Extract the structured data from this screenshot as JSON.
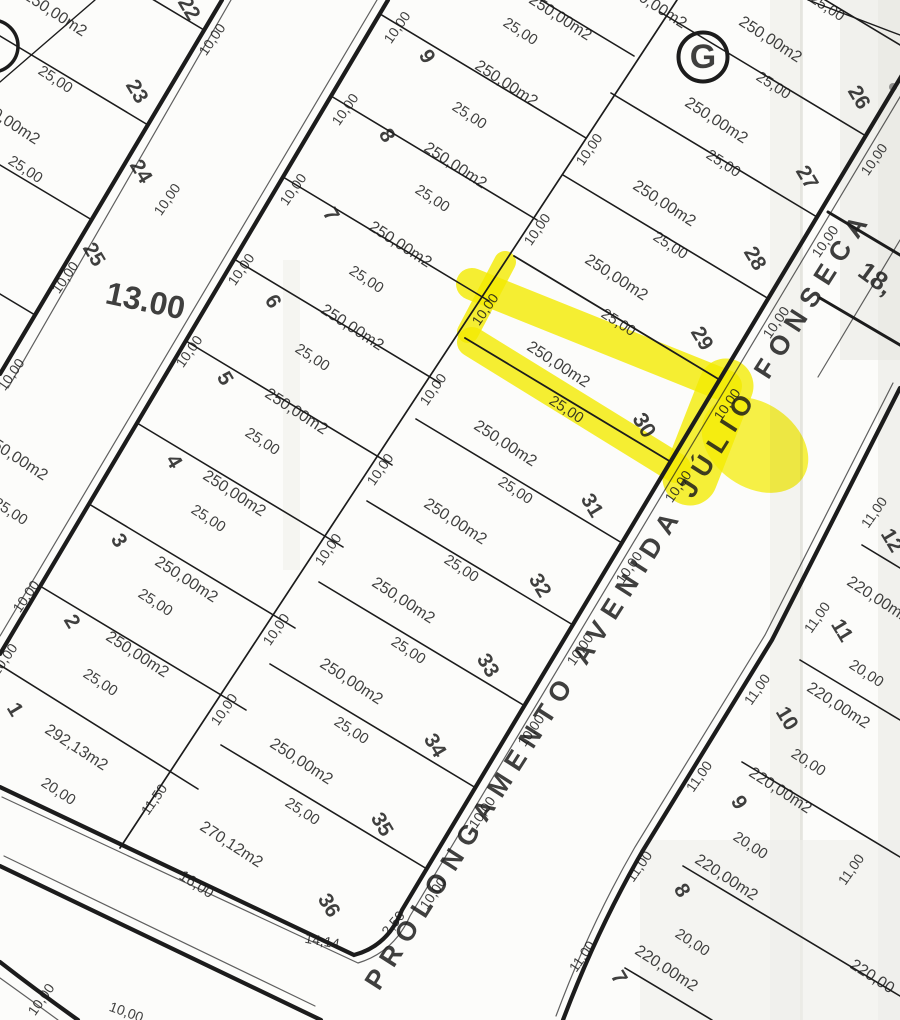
{
  "map": {
    "type": "cadastral-plat-scan",
    "street": {
      "avenue_name": "PROLONGAMENTO AVENIDA JÚLIO FONSECA",
      "left_street_width": "13.00",
      "right_street_width": "18,"
    },
    "block_marker": "G",
    "highlighted_lot": {
      "number": "30",
      "area": "250,00m2",
      "depth": "25,00",
      "front": "10,00",
      "highlight_color": "#f6ee00"
    },
    "left_block_lots": [
      "22",
      "23",
      "24",
      "25"
    ],
    "middle_block_left_column_lots": [
      "1",
      "2",
      "3",
      "4",
      "5",
      "6",
      "7",
      "8",
      "9"
    ],
    "middle_block_right_column_lots": [
      "26",
      "27",
      "28",
      "29",
      "30",
      "31",
      "32",
      "33",
      "34",
      "35",
      "36"
    ],
    "right_block_lots": [
      "7",
      "8",
      "9",
      "10",
      "11",
      "12"
    ],
    "standard_lot": {
      "area": "250,00m2",
      "depth": "25,00",
      "front": "10,00"
    },
    "right_block_lot": {
      "area": "220,00m2",
      "depth": "20,00",
      "front": "11,00"
    },
    "special_lots": {
      "lot_1": {
        "area": "292,13m2",
        "front": "20,00"
      },
      "lot_36": {
        "area": "270,12m2",
        "front": "16,00",
        "corner_chamfer": "14,14",
        "corner_offset": "2,50",
        "side": "11,50"
      }
    }
  },
  "labels": [
    {
      "t": "250,00m2",
      "x": 55,
      "y": 14,
      "r": 33,
      "s": 16
    },
    {
      "t": "25,00",
      "x": 55,
      "y": 80,
      "r": 33,
      "s": 15
    },
    {
      "t": "22",
      "x": 188,
      "y": 9,
      "r": 59,
      "s": 21,
      "w": 600
    },
    {
      "t": "23",
      "x": 136,
      "y": 92,
      "r": 59,
      "s": 21,
      "w": 600
    },
    {
      "t": "10,00",
      "x": 213,
      "y": 40,
      "r": -55,
      "s": 14
    },
    {
      "t": "250,00m2",
      "x": 8,
      "y": 122,
      "r": 33,
      "s": 16
    },
    {
      "t": "25,00",
      "x": 25,
      "y": 170,
      "r": 33,
      "s": 15
    },
    {
      "t": "24",
      "x": 140,
      "y": 172,
      "r": 59,
      "s": 21,
      "w": 600
    },
    {
      "t": "10,00",
      "x": 168,
      "y": 200,
      "r": -55,
      "s": 14
    },
    {
      "t": "25",
      "x": 93,
      "y": 255,
      "r": 59,
      "s": 21,
      "w": 600
    },
    {
      "t": "10,00",
      "x": 66,
      "y": 278,
      "r": -55,
      "s": 14
    },
    {
      "t": "10,00",
      "x": 12,
      "y": 375,
      "r": -55,
      "s": 14
    },
    {
      "t": "13.00",
      "x": 145,
      "y": 303,
      "r": 12,
      "s": 32,
      "w": 600,
      "n": "street-width-label"
    },
    {
      "t": "250,00m2",
      "x": 560,
      "y": 18,
      "r": 33,
      "s": 16
    },
    {
      "t": "25,00",
      "x": 520,
      "y": 32,
      "r": 33,
      "s": 15
    },
    {
      "t": "9",
      "x": 426,
      "y": 57,
      "r": 59,
      "s": 21,
      "w": 600
    },
    {
      "t": "250,00m2",
      "x": 506,
      "y": 84,
      "r": 33,
      "s": 16
    },
    {
      "t": "25,00",
      "x": 469,
      "y": 116,
      "r": 33,
      "s": 15
    },
    {
      "t": "8",
      "x": 386,
      "y": 136,
      "r": 59,
      "s": 21,
      "w": 600
    },
    {
      "t": "250,00m2",
      "x": 455,
      "y": 166,
      "r": 33,
      "s": 16
    },
    {
      "t": "25,00",
      "x": 432,
      "y": 199,
      "r": 33,
      "s": 15
    },
    {
      "t": "7",
      "x": 330,
      "y": 215,
      "r": 59,
      "s": 21,
      "w": 600
    },
    {
      "t": "250,00m2",
      "x": 400,
      "y": 245,
      "r": 33,
      "s": 16
    },
    {
      "t": "25,00",
      "x": 366,
      "y": 280,
      "r": 33,
      "s": 15
    },
    {
      "t": "6",
      "x": 272,
      "y": 302,
      "r": 59,
      "s": 21,
      "w": 600
    },
    {
      "t": "250,00m2",
      "x": 352,
      "y": 328,
      "r": 33,
      "s": 16
    },
    {
      "t": "25,00",
      "x": 312,
      "y": 358,
      "r": 33,
      "s": 15
    },
    {
      "t": "5",
      "x": 224,
      "y": 379,
      "r": 59,
      "s": 21,
      "w": 600
    },
    {
      "t": "250,00m2",
      "x": 296,
      "y": 412,
      "r": 33,
      "s": 16,
      "o": 0.55
    },
    {
      "t": "25,00",
      "x": 262,
      "y": 442,
      "r": 33,
      "s": 15
    },
    {
      "t": "4",
      "x": 173,
      "y": 462,
      "r": 59,
      "s": 21,
      "w": 600
    },
    {
      "t": "250,00m2",
      "x": 234,
      "y": 494,
      "r": 33,
      "s": 16
    },
    {
      "t": "25,00",
      "x": 208,
      "y": 519,
      "r": 33,
      "s": 15
    },
    {
      "t": "3",
      "x": 118,
      "y": 541,
      "r": 59,
      "s": 21,
      "w": 600
    },
    {
      "t": "250,00m2",
      "x": 186,
      "y": 580,
      "r": 33,
      "s": 16
    },
    {
      "t": "25,00",
      "x": 155,
      "y": 603,
      "r": 33,
      "s": 15
    },
    {
      "t": "2",
      "x": 71,
      "y": 622,
      "r": 59,
      "s": 21,
      "w": 600
    },
    {
      "t": "250,00m2",
      "x": 137,
      "y": 655,
      "r": 33,
      "s": 16
    },
    {
      "t": "25,00",
      "x": 100,
      "y": 683,
      "r": 33,
      "s": 15
    },
    {
      "t": "1",
      "x": 14,
      "y": 710,
      "r": 59,
      "s": 21,
      "w": 600
    },
    {
      "t": "292,13m2",
      "x": 76,
      "y": 748,
      "r": 33,
      "s": 16
    },
    {
      "t": "20,00",
      "x": 58,
      "y": 792,
      "r": 33,
      "s": 15
    },
    {
      "t": "10,00",
      "x": 398,
      "y": 28,
      "r": -55,
      "s": 14
    },
    {
      "t": "10,00",
      "x": 346,
      "y": 110,
      "r": -55,
      "s": 14
    },
    {
      "t": "10,00",
      "x": 294,
      "y": 190,
      "r": -55,
      "s": 14
    },
    {
      "t": "10,00",
      "x": 242,
      "y": 270,
      "r": -55,
      "s": 14
    },
    {
      "t": "10,00",
      "x": 190,
      "y": 352,
      "r": -55,
      "s": 14
    },
    {
      "t": "10,00",
      "x": 27,
      "y": 597,
      "r": -55,
      "s": 14
    },
    {
      "t": "10,00",
      "x": 5,
      "y": 660,
      "r": -55,
      "s": 14
    },
    {
      "t": "250,00m2",
      "x": 655,
      "y": 6,
      "r": 33,
      "s": 16
    },
    {
      "t": "25,00",
      "x": 827,
      "y": 8,
      "r": 33,
      "s": 15
    },
    {
      "t": "G",
      "x": 703,
      "y": 59,
      "r": 0,
      "s": 34,
      "w": 700,
      "n": "block-marker-g"
    },
    {
      "t": "250,00m2",
      "x": 770,
      "y": 40,
      "r": 33,
      "s": 16
    },
    {
      "t": "25,00",
      "x": 773,
      "y": 86,
      "r": 33,
      "s": 15
    },
    {
      "t": "26",
      "x": 858,
      "y": 98,
      "r": 59,
      "s": 21,
      "w": 600
    },
    {
      "t": "250,00m2",
      "x": 716,
      "y": 121,
      "r": 33,
      "s": 16
    },
    {
      "t": "25,00",
      "x": 723,
      "y": 164,
      "r": 33,
      "s": 15
    },
    {
      "t": "27",
      "x": 806,
      "y": 178,
      "r": 59,
      "s": 21,
      "w": 600
    },
    {
      "t": "250,00m2",
      "x": 664,
      "y": 204,
      "r": 33,
      "s": 16
    },
    {
      "t": "25,00",
      "x": 670,
      "y": 246,
      "r": 33,
      "s": 15
    },
    {
      "t": "28",
      "x": 754,
      "y": 259,
      "r": 59,
      "s": 21,
      "w": 600
    },
    {
      "t": "250,00m2",
      "x": 616,
      "y": 278,
      "r": 33,
      "s": 16
    },
    {
      "t": "25,00",
      "x": 618,
      "y": 323,
      "r": 33,
      "s": 15
    },
    {
      "t": "29",
      "x": 701,
      "y": 339,
      "r": 59,
      "s": 21,
      "w": 600
    },
    {
      "t": "250,00m2",
      "x": 558,
      "y": 365,
      "r": 33,
      "s": 16,
      "n": "lot-30-area"
    },
    {
      "t": "25,00",
      "x": 566,
      "y": 410,
      "r": 33,
      "s": 15,
      "n": "lot-30-depth"
    },
    {
      "t": "30",
      "x": 643,
      "y": 426,
      "r": 59,
      "s": 22,
      "w": 600,
      "n": "lot-30-number"
    },
    {
      "t": "250,00m2",
      "x": 505,
      "y": 444,
      "r": 33,
      "s": 16
    },
    {
      "t": "25,00",
      "x": 515,
      "y": 491,
      "r": 33,
      "s": 15
    },
    {
      "t": "31",
      "x": 591,
      "y": 506,
      "r": 59,
      "s": 21,
      "w": 600
    },
    {
      "t": "250,00m2",
      "x": 455,
      "y": 522,
      "r": 33,
      "s": 16
    },
    {
      "t": "25,00",
      "x": 461,
      "y": 569,
      "r": 33,
      "s": 15
    },
    {
      "t": "32",
      "x": 539,
      "y": 586,
      "r": 59,
      "s": 21,
      "w": 600
    },
    {
      "t": "250,00m2",
      "x": 403,
      "y": 601,
      "r": 33,
      "s": 16
    },
    {
      "t": "25,00",
      "x": 408,
      "y": 651,
      "r": 33,
      "s": 15
    },
    {
      "t": "33",
      "x": 487,
      "y": 666,
      "r": 59,
      "s": 21,
      "w": 600
    },
    {
      "t": "250,00m2",
      "x": 351,
      "y": 682,
      "r": 33,
      "s": 16
    },
    {
      "t": "25,00",
      "x": 351,
      "y": 731,
      "r": 33,
      "s": 15
    },
    {
      "t": "34",
      "x": 434,
      "y": 746,
      "r": 59,
      "s": 21,
      "w": 600
    },
    {
      "t": "250,00m2",
      "x": 301,
      "y": 762,
      "r": 33,
      "s": 16
    },
    {
      "t": "25,00",
      "x": 302,
      "y": 812,
      "r": 33,
      "s": 15
    },
    {
      "t": "35",
      "x": 381,
      "y": 825,
      "r": 59,
      "s": 21,
      "w": 600
    },
    {
      "t": "270,12m2",
      "x": 231,
      "y": 845,
      "r": 33,
      "s": 16
    },
    {
      "t": "16,00",
      "x": 196,
      "y": 885,
      "r": 33,
      "s": 15
    },
    {
      "t": "36",
      "x": 328,
      "y": 906,
      "r": 59,
      "s": 21,
      "w": 600
    },
    {
      "t": "14,14",
      "x": 322,
      "y": 942,
      "r": 10,
      "s": 14
    },
    {
      "t": "2,50",
      "x": 394,
      "y": 924,
      "r": -50,
      "s": 14
    },
    {
      "t": "11,50",
      "x": 155,
      "y": 800,
      "r": -55,
      "s": 14
    },
    {
      "t": "10,00",
      "x": 590,
      "y": 150,
      "r": -55,
      "s": 14
    },
    {
      "t": "10,00",
      "x": 538,
      "y": 230,
      "r": -55,
      "s": 14
    },
    {
      "t": "10,00",
      "x": 486,
      "y": 310,
      "r": -55,
      "s": 14
    },
    {
      "t": "10,00",
      "x": 434,
      "y": 390,
      "r": -55,
      "s": 14
    },
    {
      "t": "10,00",
      "x": 381,
      "y": 470,
      "r": -55,
      "s": 14
    },
    {
      "t": "10,00",
      "x": 329,
      "y": 550,
      "r": -55,
      "s": 14
    },
    {
      "t": "10,00",
      "x": 277,
      "y": 630,
      "r": -55,
      "s": 14
    },
    {
      "t": "10,00",
      "x": 225,
      "y": 710,
      "r": -55,
      "s": 14
    },
    {
      "t": "10,00",
      "x": 875,
      "y": 160,
      "r": -55,
      "s": 14
    },
    {
      "t": "10,00",
      "x": 826,
      "y": 242,
      "r": -55,
      "s": 14
    },
    {
      "t": "10,00",
      "x": 777,
      "y": 323,
      "r": -55,
      "s": 14
    },
    {
      "t": "10,00",
      "x": 728,
      "y": 405,
      "r": -55,
      "s": 14
    },
    {
      "t": "10,00",
      "x": 679,
      "y": 487,
      "r": -55,
      "s": 14
    },
    {
      "t": "10,00",
      "x": 630,
      "y": 568,
      "r": -55,
      "s": 14
    },
    {
      "t": "10,00",
      "x": 581,
      "y": 650,
      "r": -55,
      "s": 14
    },
    {
      "t": "10,00",
      "x": 532,
      "y": 731,
      "r": -55,
      "s": 14
    },
    {
      "t": "10,00",
      "x": 483,
      "y": 813,
      "r": -55,
      "s": 14
    },
    {
      "t": "10,00",
      "x": 434,
      "y": 894,
      "r": -55,
      "s": 14
    },
    {
      "t": "PROLONGAMENTO AVENIDA JÚLIO FONSECA",
      "x": 620,
      "y": 600,
      "r": -57.5,
      "s": 27,
      "w": 600,
      "sp": 9,
      "n": "street-name"
    },
    {
      "t": "18,",
      "x": 875,
      "y": 280,
      "r": 36,
      "s": 26,
      "w": 600,
      "n": "width-18-label"
    },
    {
      "t": "220,00m2",
      "x": 878,
      "y": 600,
      "r": 33,
      "s": 16
    },
    {
      "t": "12",
      "x": 891,
      "y": 541,
      "r": 59,
      "s": 21,
      "w": 600
    },
    {
      "t": "11,00",
      "x": 875,
      "y": 513,
      "r": -55,
      "s": 14
    },
    {
      "t": "11",
      "x": 841,
      "y": 631,
      "r": 59,
      "s": 21,
      "w": 600
    },
    {
      "t": "20,00",
      "x": 866,
      "y": 674,
      "r": 33,
      "s": 15
    },
    {
      "t": "220,00m2",
      "x": 838,
      "y": 706,
      "r": 33,
      "s": 16
    },
    {
      "t": "10",
      "x": 786,
      "y": 719,
      "r": 59,
      "s": 21,
      "w": 600
    },
    {
      "t": "20,00",
      "x": 808,
      "y": 763,
      "r": 33,
      "s": 15
    },
    {
      "t": "220,00m2",
      "x": 780,
      "y": 791,
      "r": 33,
      "s": 16
    },
    {
      "t": "9",
      "x": 738,
      "y": 803,
      "r": 59,
      "s": 21,
      "w": 600
    },
    {
      "t": "20,00",
      "x": 750,
      "y": 846,
      "r": 33,
      "s": 15
    },
    {
      "t": "220,00m2",
      "x": 726,
      "y": 878,
      "r": 33,
      "s": 16
    },
    {
      "t": "8",
      "x": 681,
      "y": 891,
      "r": 59,
      "s": 21,
      "w": 600
    },
    {
      "t": "20,00",
      "x": 692,
      "y": 943,
      "r": 33,
      "s": 15
    },
    {
      "t": "220,00m2",
      "x": 666,
      "y": 969,
      "r": 33,
      "s": 16
    },
    {
      "t": "7",
      "x": 618,
      "y": 978,
      "r": 59,
      "s": 21,
      "w": 600
    },
    {
      "t": "11,00",
      "x": 818,
      "y": 618,
      "r": -55,
      "s": 14
    },
    {
      "t": "11,00",
      "x": 758,
      "y": 690,
      "r": -55,
      "s": 14
    },
    {
      "t": "11,00",
      "x": 700,
      "y": 777,
      "r": -55,
      "s": 14
    },
    {
      "t": "11,00",
      "x": 640,
      "y": 867,
      "r": -55,
      "s": 14
    },
    {
      "t": "11,00",
      "x": 583,
      "y": 957,
      "r": -55,
      "s": 14
    },
    {
      "t": "11,00",
      "x": 852,
      "y": 870,
      "r": -55,
      "s": 14
    },
    {
      "t": "220,00",
      "x": 872,
      "y": 977,
      "r": 33,
      "s": 16
    },
    {
      "t": "10,00",
      "x": 42,
      "y": 1000,
      "r": -55,
      "s": 14
    },
    {
      "t": "10,00",
      "x": 126,
      "y": 1013,
      "r": 20,
      "s": 14
    },
    {
      "t": "250,00m2",
      "x": 16,
      "y": 458,
      "r": 33,
      "s": 16,
      "o": 0.18
    },
    {
      "t": "25,00",
      "x": 10,
      "y": 512,
      "r": 33,
      "s": 15,
      "o": 0.18
    }
  ]
}
